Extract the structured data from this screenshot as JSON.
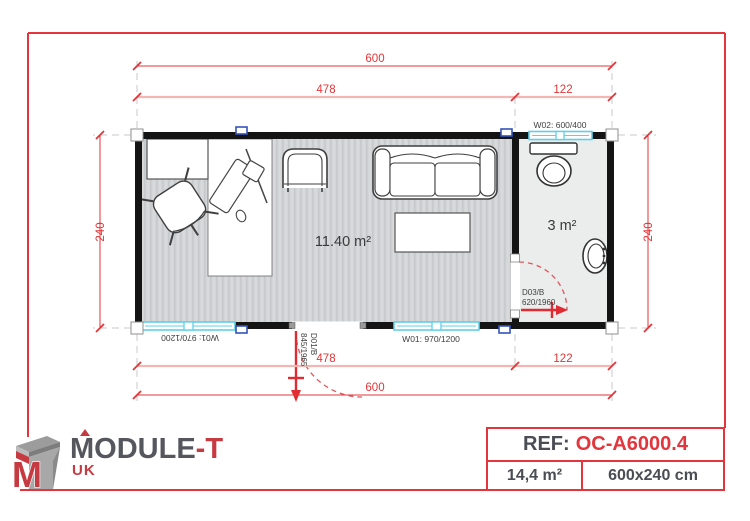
{
  "plan": {
    "dimensions": {
      "top_total": "600",
      "top_left": "478",
      "top_right": "122",
      "bottom_left": "478",
      "bottom_right": "122",
      "bottom_total": "600",
      "left_height": "240",
      "right_height": "240"
    },
    "rooms": {
      "office_area": "11.40 m²",
      "bathroom_area": "3 m²"
    },
    "openings": {
      "window_w02": "W02: 600/400",
      "window_w01_left": "W01: 970/1200",
      "window_w01_right": "W01: 970/1200",
      "door_d01_code": "D01/B",
      "door_d01_size": "845/1965",
      "door_d03_code": "D03/B",
      "door_d03_size": "620/1960"
    }
  },
  "footer": {
    "logo": {
      "brand_main": "MODULE",
      "brand_suffix": "-T",
      "region": "UK"
    },
    "ref_box": {
      "ref_label": "REF:",
      "ref_value": "OC-A6000.4",
      "total_area": "14,4 m²",
      "dimensions": "600x240 cm"
    }
  },
  "colors": {
    "accent_red": "#e2353c",
    "dim_red": "#e43437",
    "dim_pale": "#f4b6b3",
    "wall_black": "#141414",
    "window_cyan": "#5fcfe8",
    "marker_blue": "#3453b8",
    "logo_gray": "#55565e",
    "logo_red": "#c63b42"
  }
}
